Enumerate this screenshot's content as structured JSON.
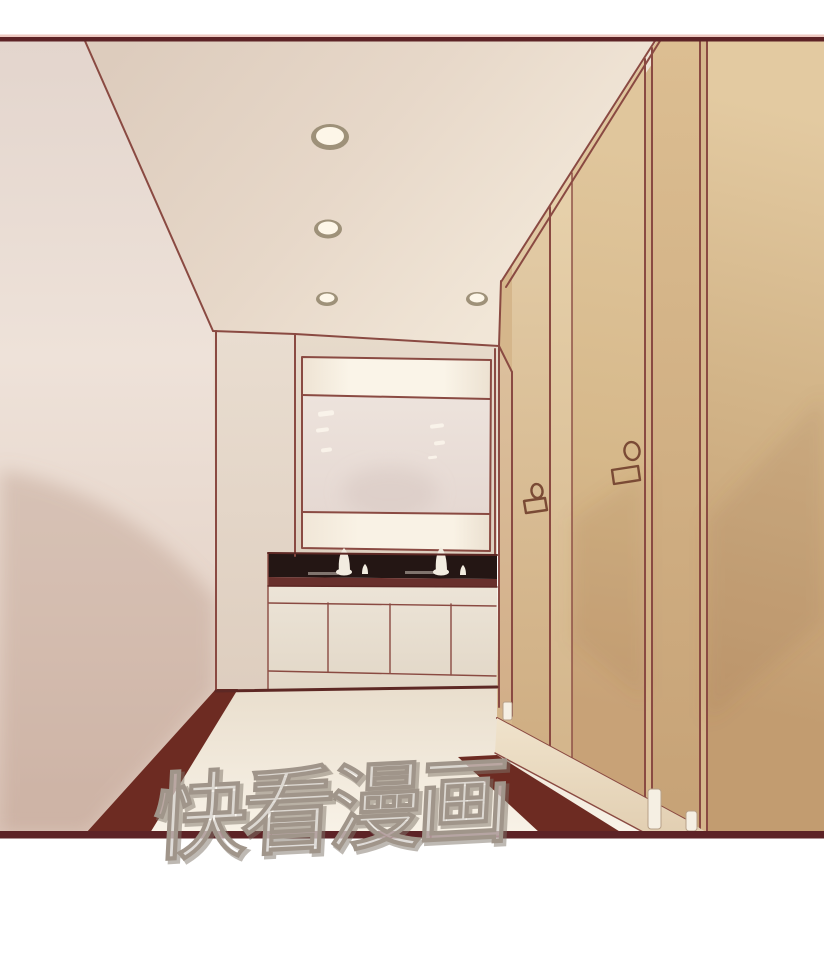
{
  "watermark": {
    "text": "快看漫画"
  },
  "scene": {
    "panel_type": "comic-panel",
    "ceiling_light_count": 4,
    "stall_door_lock_count": 2,
    "faucet_count": 2
  },
  "palette": {
    "page-bg": "#ffffff",
    "line": "#8a4a42",
    "line-dark": "#5d2824",
    "border": "#5d2326",
    "border-highlight": "#eec9c1",
    "counter": "#241614",
    "counter-edge": "#68302c",
    "dark-band": "#6d2b22",
    "stall-base": "#d5b68b",
    "foot": "#f5efe3",
    "lock": "#7a4a35",
    "light-rim": "#9e9179",
    "light-core": "#fdf6e8",
    "faucet": "#f2ece0",
    "mirror-streak": "#fbf6ec",
    "watermark-fill": "rgba(255,255,255,0.5)",
    "watermark-stroke": "#a0958a"
  }
}
